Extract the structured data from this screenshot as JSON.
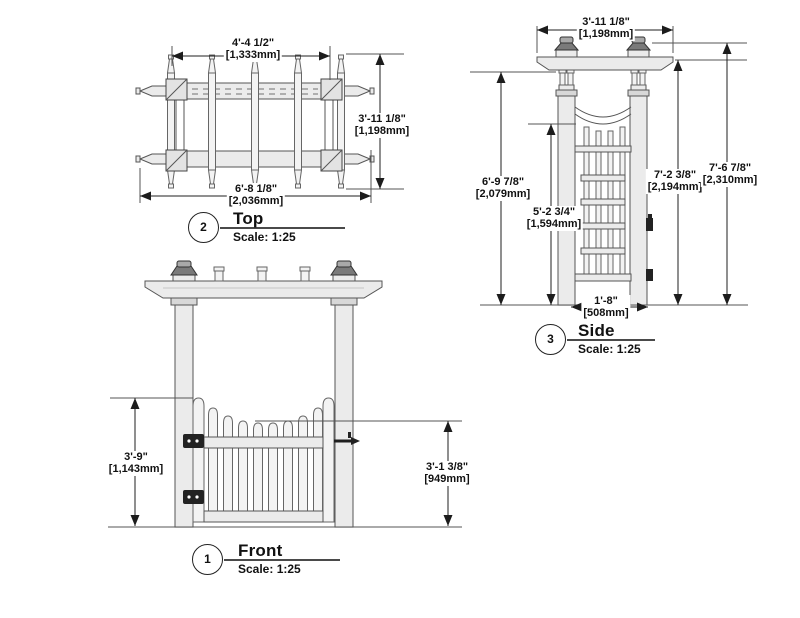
{
  "palette": {
    "line": "#4d4d4d",
    "dim_line": "#1f1f1f",
    "wood_fill": "#ebebeb",
    "hardware": "#222222",
    "text": "#111111"
  },
  "views": {
    "front": {
      "number": "1",
      "title": "Front",
      "scale": "Scale: 1:25",
      "dims": {
        "gate_height": {
          "imperial": "3'-9\"",
          "metric": "[1,143mm]"
        },
        "picket_height": {
          "imperial": "3'-1 3/8\"",
          "metric": "[949mm]"
        }
      }
    },
    "top": {
      "number": "2",
      "title": "Top",
      "scale": "Scale: 1:25",
      "dims": {
        "inner_width": {
          "imperial": "4'-4 1/2\"",
          "metric": "[1,333mm]"
        },
        "depth": {
          "imperial": "3'-11 1/8\"",
          "metric": "[1,198mm]"
        },
        "overall_width": {
          "imperial": "6'-8 1/8\"",
          "metric": "[2,036mm]"
        }
      }
    },
    "side": {
      "number": "3",
      "title": "Side",
      "scale": "Scale: 1:25",
      "dims": {
        "beam_length": {
          "imperial": "3'-11 1/8\"",
          "metric": "[1,198mm]"
        },
        "post_height": {
          "imperial": "6'-9 7/8\"",
          "metric": "[2,079mm]"
        },
        "arch_clearance": {
          "imperial": "5'-2 3/4\"",
          "metric": "[1,594mm]"
        },
        "beam_top_height": {
          "imperial": "7'-2 3/8\"",
          "metric": "[2,194mm]"
        },
        "overall_height": {
          "imperial": "7'-6 7/8\"",
          "metric": "[2,310mm]"
        },
        "opening_depth": {
          "imperial": "1'-8\"",
          "metric": "[508mm]"
        }
      }
    }
  }
}
